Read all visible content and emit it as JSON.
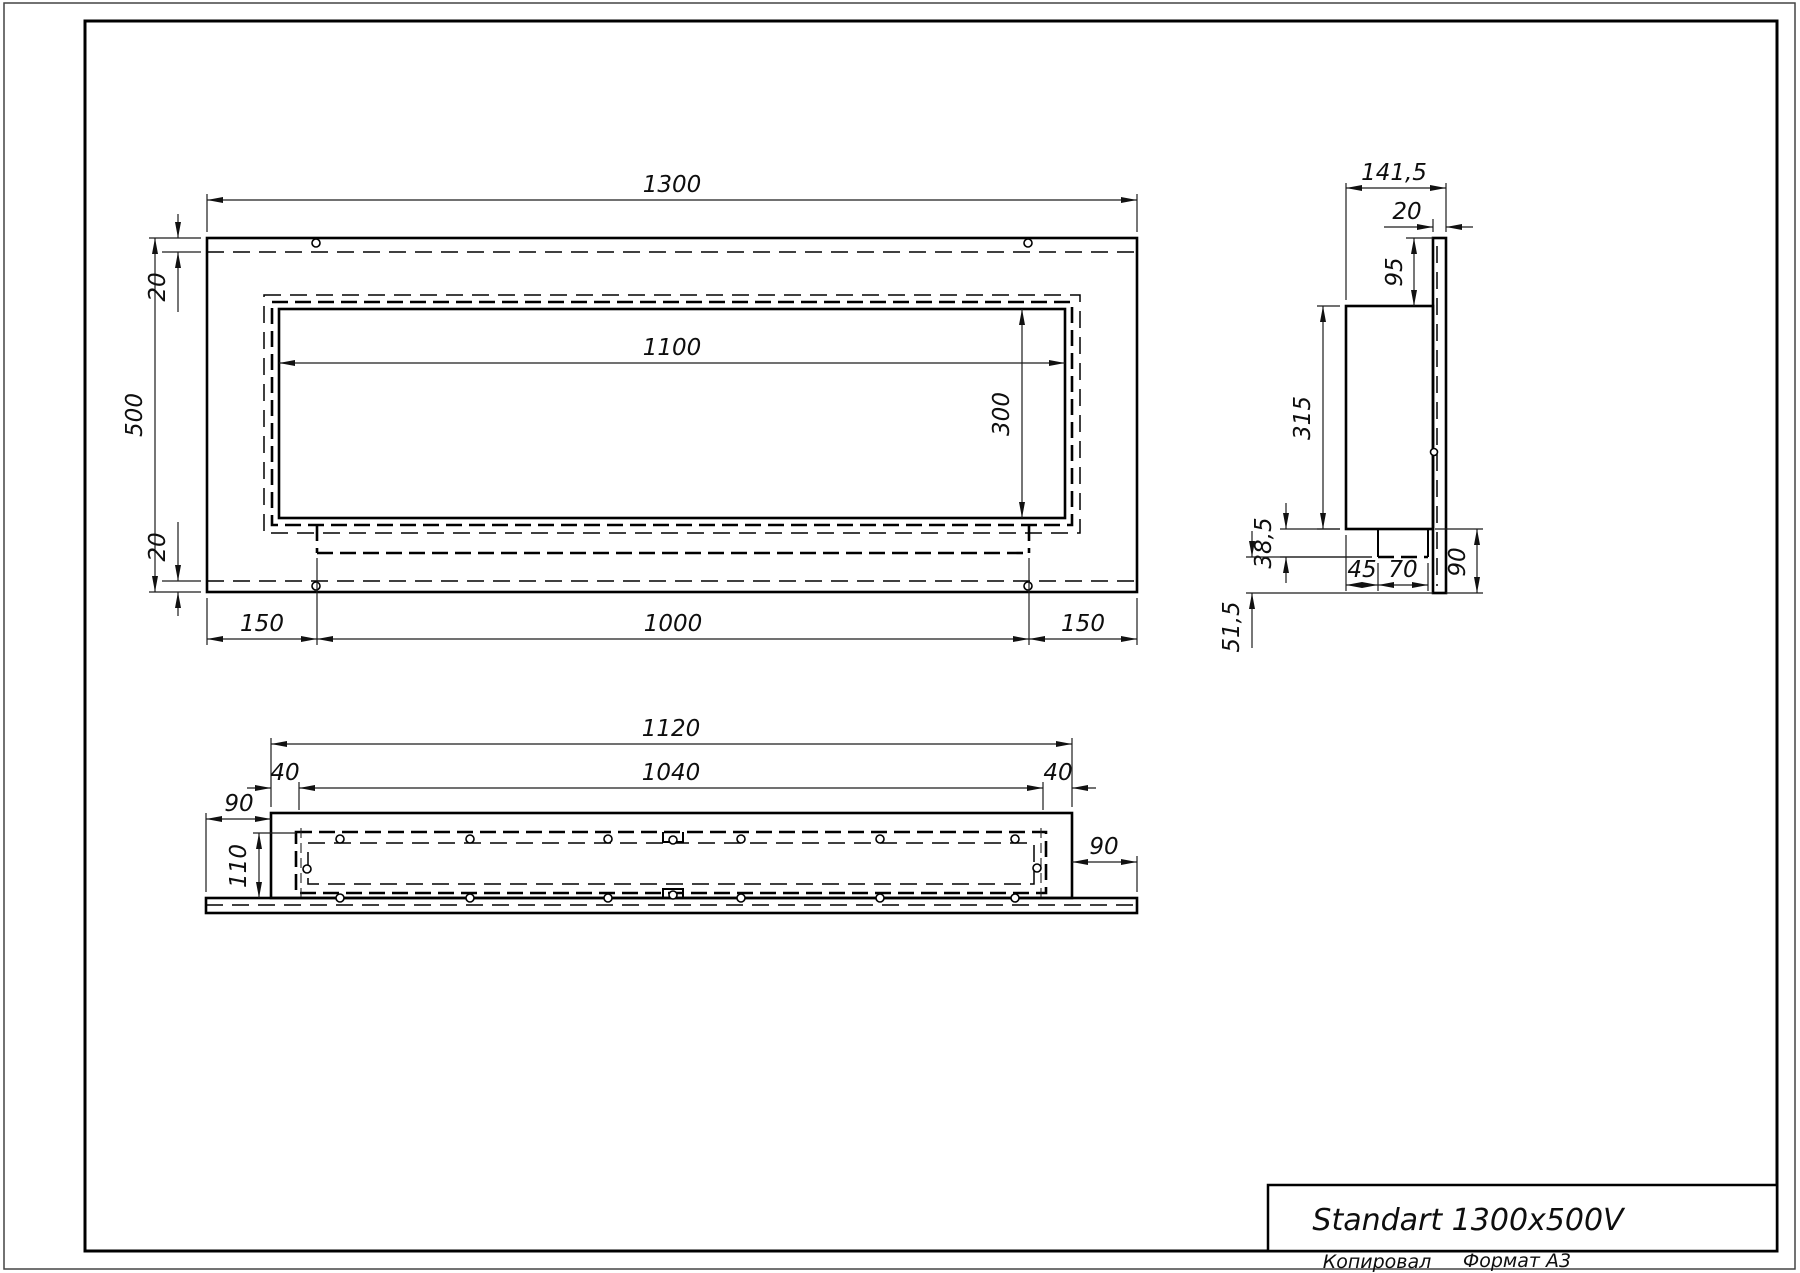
{
  "title_block": {
    "title": "Standart 1300x500V",
    "copied_label": "Копировал",
    "format_label": "Формат А3"
  },
  "front_view": {
    "width": "1300",
    "height": "500",
    "opening_width": "1100",
    "opening_height": "300",
    "top_gap": "20",
    "bottom_gap": "20",
    "left_margin": "150",
    "center_span": "1000",
    "right_margin": "150"
  },
  "side_view": {
    "depth": "141,5",
    "plate_thickness": "20",
    "top_offset": "95",
    "body_height": "315",
    "foot_height": "38,5",
    "bottom_offset": "51,5",
    "foot_inset": "45",
    "foot_length": "70",
    "plate_drop": "90"
  },
  "plan_view": {
    "body_width": "1120",
    "inner_width": "1040",
    "left_end": "40",
    "right_end": "40",
    "left_overhang": "90",
    "right_overhang": "90",
    "depth": "110"
  }
}
